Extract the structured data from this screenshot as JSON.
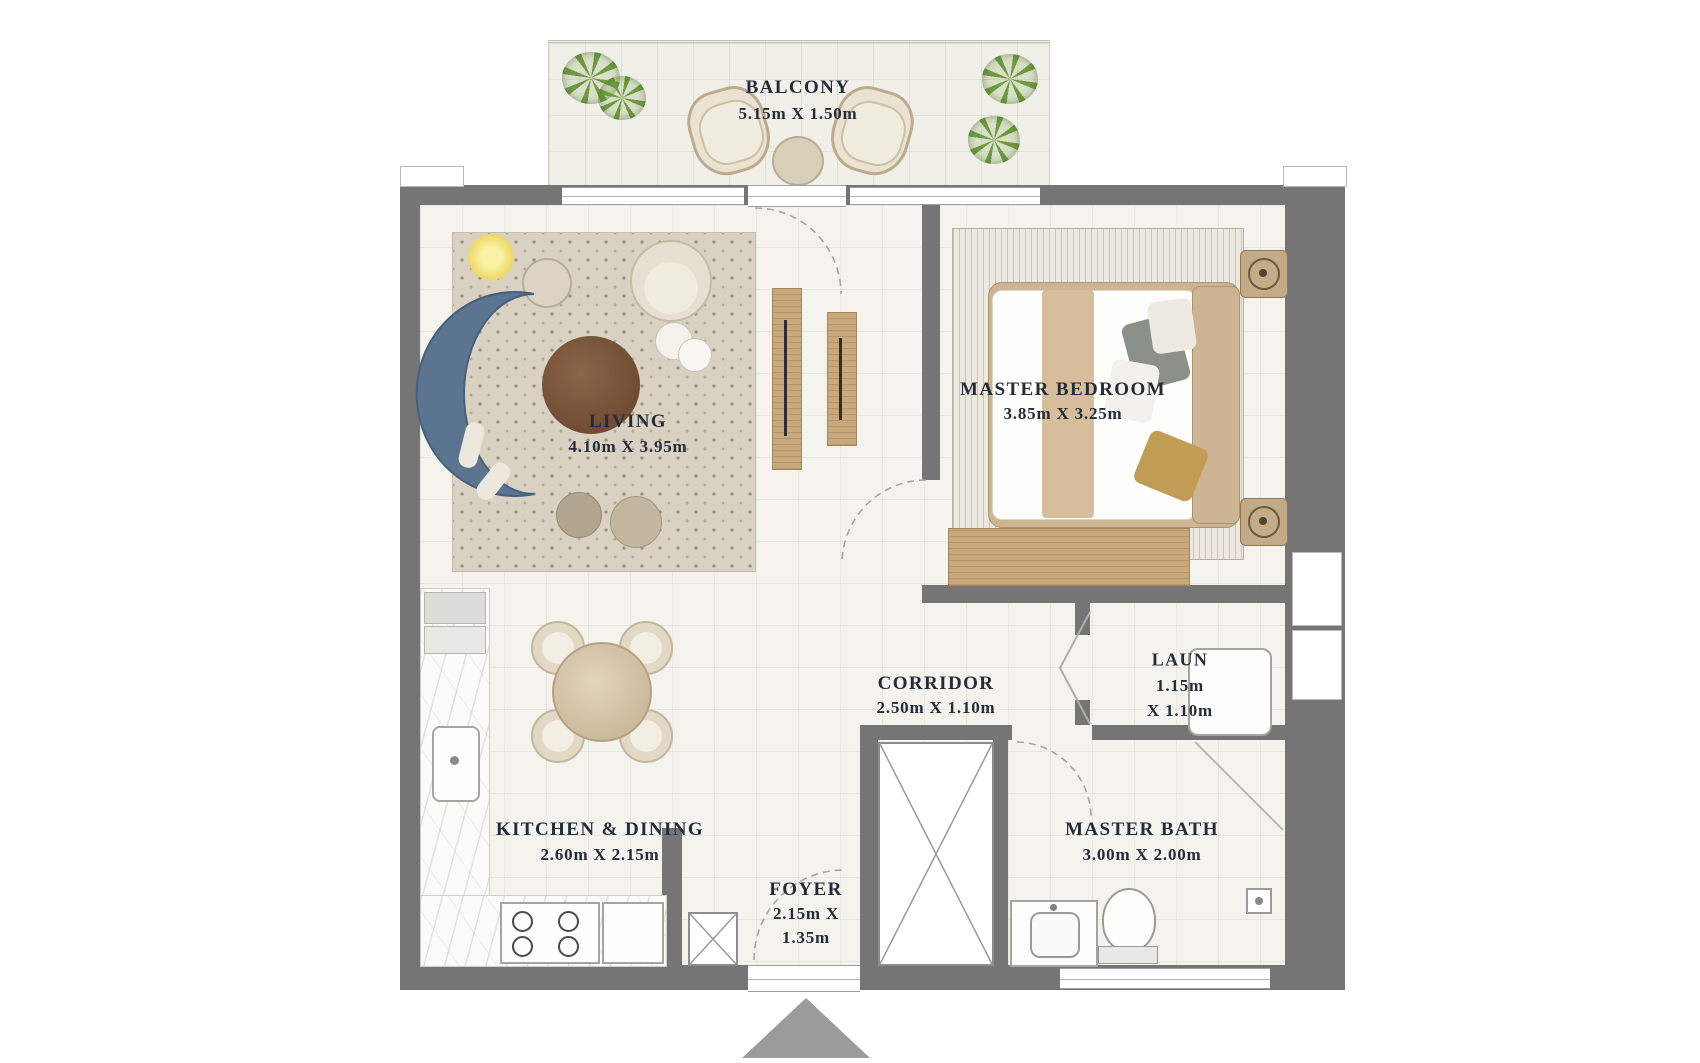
{
  "plan_type": "apartment-floor-plan",
  "rooms": {
    "balcony": {
      "name": "BALCONY",
      "dims": "5.15m X 1.50m"
    },
    "living": {
      "name": "LIVING",
      "dims": "4.10m X 3.95m"
    },
    "master_bedroom": {
      "name": "MASTER BEDROOM",
      "dims": "3.85m X 3.25m"
    },
    "corridor": {
      "name": "CORRIDOR",
      "dims": "2.50m X 1.10m"
    },
    "laundry": {
      "name": "LAUN",
      "dims_line1": "1.15m",
      "dims_line2": "X 1.10m"
    },
    "kitchen_dining": {
      "name": "KITCHEN & DINING",
      "dims": "2.60m X 2.15m"
    },
    "master_bath": {
      "name": "MASTER BATH",
      "dims": "3.00m X 2.00m"
    },
    "foyer": {
      "name": "FOYER",
      "dims_line1": "2.15m X",
      "dims_line2": "1.35m"
    }
  },
  "icons": {
    "entry_arrow": "triangle-up",
    "plant": "foliage-top-view"
  },
  "colors": {
    "wall": "#757575",
    "floor": "#f4f3ee",
    "balcony_floor": "#f0efe8",
    "rug": "#d9d2c3",
    "bedroom_rug": "#eee9e0",
    "sofa_blue": "#5b7590",
    "coffee_table_brown": "#6f4c33",
    "wood_tan": "#c9a87c",
    "bed_frame": "#cdb492",
    "plant_green": "#6f9a3f",
    "ink": "#242b39",
    "arrow_gray": "#9b9b9b",
    "marble": "#fbfbfa"
  }
}
